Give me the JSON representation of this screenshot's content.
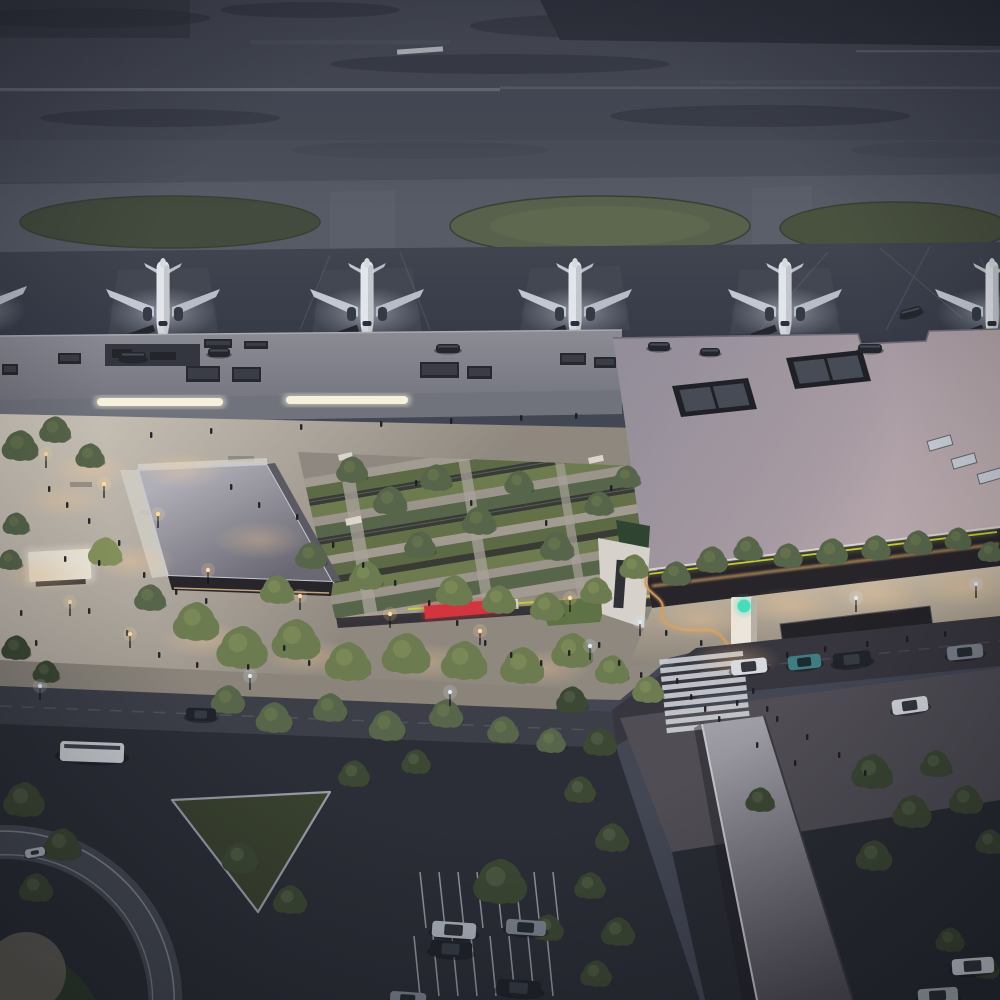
{
  "image": {
    "kind": "architectural-rendering",
    "subject": "Aerial dusk view of an airport: runway field, apron with parked jets, terminal buildings, landscaped arrival plaza with sunken gardens, drop-off road, covered pedestrian walkway and parking",
    "time_of_day": "dusk",
    "camera": "high oblique aerial"
  },
  "palette": {
    "base": "#434754",
    "runway_a": "#4e525e",
    "runway_b": "#474b57",
    "taxiway": "#575b66",
    "apron_a": "#40444f",
    "apron_b": "#353946",
    "grass_dark": "#434b3e",
    "grass_mid": "#57614c",
    "grass_light": "#626c50",
    "roof_old_a": "#8b8b94",
    "roof_old_b": "#757680",
    "roof_new_a": "#938e9a",
    "roof_new_b": "#a79aa2",
    "roof_new_c": "#c3b3b4",
    "ramp_a": "#b0afb8",
    "ramp_b": "#6a6973",
    "plaza_a": "#cfc8bd",
    "plaza_b": "#8f887f",
    "sidewalk_a": "#d2c3ab",
    "sidewalk_b": "#8e867c",
    "road": "#3c3f48",
    "road_bend": "#37353d",
    "parking": "#2b2d36",
    "walk_canopy_a": "#a09ea6",
    "walk_canopy_b": "#514e57",
    "storefront": "#3b3735",
    "storefront_light": "#d8a566",
    "tree_0": "#3c4734",
    "tree_1": "#57654a",
    "tree_2": "#6d7b50",
    "tree_3": "#85915c",
    "accent_lime": "#c9d33f",
    "accent_red": "#d2353e",
    "logo_teal": "#45dcbc",
    "warm_light": "#ffd9a0",
    "cool_light": "#dfe7f2",
    "fuselage": "#e2e5ea",
    "wing": "#c2c8d1",
    "dark_detail": "#23252c",
    "white_mark": "#ccd0d7",
    "car_colors": {
      "white": "#d7dbe0",
      "silver": "#aeb4bc",
      "gray": "#7b828c",
      "teal": "#3e7e83",
      "dark": "#20232a",
      "bus": "#c9ccd1",
      "ground": "#23262c"
    }
  },
  "airside": {
    "plane_xs": [
      163,
      367,
      575,
      785
    ],
    "partial_planes": [
      [
        -30,
        330
      ],
      [
        992,
        333
      ]
    ],
    "runway_dash": [
      397,
      48
    ]
  },
  "buildings": {
    "hvac_units": [
      [
        2,
        364,
        16,
        11
      ],
      [
        58,
        353,
        23,
        11
      ],
      [
        186,
        366,
        34,
        16
      ],
      [
        232,
        367,
        29,
        15
      ],
      [
        420,
        362,
        39,
        16
      ],
      [
        467,
        366,
        25,
        13
      ],
      [
        204,
        339,
        28,
        9
      ],
      [
        244,
        341,
        24,
        8
      ],
      [
        560,
        353,
        26,
        12
      ],
      [
        594,
        357,
        22,
        11
      ]
    ],
    "skylight_strips": [
      [
        97,
        398,
        126,
        8
      ],
      [
        286,
        396,
        122,
        8
      ]
    ],
    "roof_boxes": [
      [
        [
          672,
          386
        ],
        [
          748,
          378
        ],
        [
          757,
          409
        ],
        [
          681,
          417
        ]
      ],
      [
        [
          786,
          358
        ],
        [
          862,
          350
        ],
        [
          871,
          381
        ],
        [
          795,
          389
        ]
      ]
    ],
    "roof_vents": [
      [
        928,
        438
      ],
      [
        952,
        456
      ],
      [
        978,
        471
      ]
    ],
    "shelters": [
      [
        [
          780,
          624
        ],
        [
          930,
          606
        ],
        [
          934,
          634
        ],
        [
          784,
          652
        ]
      ],
      [
        [
          944,
          712
        ],
        [
          1000,
          700
        ],
        [
          1000,
          734
        ],
        [
          948,
          746
        ]
      ]
    ],
    "pylon": [
      731,
      597,
      26,
      56
    ]
  },
  "plaza": {
    "canopies": [
      [
        345,
        519,
        16,
        7
      ],
      [
        338,
        455,
        14,
        6
      ],
      [
        588,
        458,
        15,
        6
      ],
      [
        610,
        601,
        14,
        6
      ]
    ],
    "benches": [
      [
        70,
        482,
        22,
        5
      ],
      [
        140,
        510,
        20,
        5
      ],
      [
        228,
        456,
        26,
        6
      ],
      [
        196,
        470,
        18,
        5
      ]
    ],
    "red_bench": [
      424,
      606,
      76,
      13
    ],
    "kiosk": [
      28,
      552,
      62,
      30
    ],
    "light_pools": [
      [
        62,
        500
      ],
      [
        132,
        562
      ],
      [
        205,
        640
      ],
      [
        310,
        657
      ],
      [
        428,
        662
      ],
      [
        545,
        668
      ],
      [
        88,
        470
      ],
      [
        40,
        575
      ],
      [
        700,
        620
      ],
      [
        790,
        606
      ],
      [
        880,
        596
      ],
      [
        965,
        588
      ],
      [
        736,
        660
      ],
      [
        180,
        470
      ],
      [
        260,
        540
      ]
    ]
  },
  "roadside": {
    "zebra": {
      "x": 663,
      "y": 655,
      "w": 84,
      "h": 5.2,
      "step": 8.6,
      "count": 9,
      "angle": -6
    },
    "parking_rows": [
      {
        "x": 420,
        "y": 872,
        "n": 8,
        "dx": 19,
        "len": 56
      },
      {
        "x": 414,
        "y": 936,
        "n": 8,
        "dx": 19,
        "len": 60
      }
    ],
    "storefront_lights": {
      "x0": 8,
      "x1": 616,
      "step": 26,
      "slope": 0.0316,
      "y0": 432
    }
  },
  "entities": {
    "trees": [
      [
        20,
        446,
        15,
        1
      ],
      [
        55,
        430,
        13,
        1
      ],
      [
        90,
        456,
        12,
        1
      ],
      [
        16,
        524,
        11,
        1
      ],
      [
        10,
        560,
        10,
        1
      ],
      [
        105,
        552,
        14,
        3
      ],
      [
        150,
        598,
        13,
        1
      ],
      [
        196,
        622,
        19,
        2
      ],
      [
        242,
        648,
        21,
        2
      ],
      [
        296,
        640,
        20,
        2
      ],
      [
        348,
        662,
        19,
        2
      ],
      [
        406,
        654,
        20,
        2
      ],
      [
        464,
        661,
        19,
        2
      ],
      [
        522,
        666,
        18,
        2
      ],
      [
        572,
        651,
        17,
        2
      ],
      [
        612,
        670,
        14,
        2
      ],
      [
        648,
        690,
        13,
        2
      ],
      [
        352,
        470,
        13,
        1
      ],
      [
        390,
        501,
        14,
        1
      ],
      [
        436,
        478,
        13,
        1
      ],
      [
        479,
        521,
        14,
        1
      ],
      [
        519,
        483,
        12,
        1
      ],
      [
        557,
        547,
        14,
        1
      ],
      [
        599,
        504,
        12,
        1
      ],
      [
        627,
        477,
        11,
        1
      ],
      [
        454,
        591,
        15,
        2
      ],
      [
        499,
        600,
        14,
        2
      ],
      [
        547,
        607,
        14,
        2
      ],
      [
        596,
        591,
        13,
        2
      ],
      [
        634,
        567,
        12,
        2
      ],
      [
        420,
        545,
        13,
        1
      ],
      [
        366,
        576,
        14,
        2
      ],
      [
        311,
        556,
        13,
        1
      ],
      [
        277,
        590,
        14,
        2
      ],
      [
        676,
        574,
        12,
        1
      ],
      [
        712,
        560,
        13,
        1
      ],
      [
        748,
        549,
        12,
        1
      ],
      [
        788,
        556,
        12,
        1
      ],
      [
        832,
        552,
        13,
        1
      ],
      [
        876,
        548,
        12,
        1
      ],
      [
        918,
        543,
        12,
        1
      ],
      [
        958,
        539,
        11,
        1
      ],
      [
        990,
        552,
        10,
        1
      ],
      [
        228,
        700,
        14,
        1
      ],
      [
        274,
        718,
        15,
        1
      ],
      [
        330,
        708,
        14,
        1
      ],
      [
        387,
        726,
        15,
        1
      ],
      [
        446,
        714,
        14,
        1
      ],
      [
        503,
        730,
        13,
        1
      ],
      [
        551,
        741,
        12,
        1
      ],
      [
        16,
        648,
        12,
        0
      ],
      [
        46,
        672,
        11,
        0
      ],
      [
        24,
        800,
        17,
        0
      ],
      [
        62,
        845,
        16,
        0
      ],
      [
        36,
        888,
        14,
        0
      ],
      [
        240,
        858,
        15,
        0
      ],
      [
        290,
        900,
        14,
        0
      ],
      [
        500,
        882,
        22,
        0
      ],
      [
        548,
        928,
        13,
        0
      ],
      [
        354,
        774,
        13,
        0
      ],
      [
        416,
        762,
        12,
        0
      ],
      [
        572,
        700,
        13,
        0
      ],
      [
        600,
        742,
        14,
        0
      ],
      [
        580,
        790,
        13,
        0
      ],
      [
        612,
        838,
        14,
        0
      ],
      [
        590,
        886,
        13,
        0
      ],
      [
        618,
        932,
        14,
        0
      ],
      [
        596,
        974,
        13,
        0
      ],
      [
        872,
        772,
        17,
        0
      ],
      [
        912,
        812,
        16,
        0
      ],
      [
        874,
        856,
        15,
        0
      ],
      [
        936,
        764,
        13,
        0
      ],
      [
        966,
        800,
        14,
        0
      ],
      [
        990,
        842,
        12,
        0
      ],
      [
        950,
        940,
        12,
        0
      ],
      [
        986,
        968,
        11,
        0
      ],
      [
        760,
        800,
        12,
        0
      ]
    ],
    "people": [
      [
        48,
        486
      ],
      [
        66,
        502
      ],
      [
        88,
        518
      ],
      [
        118,
        540
      ],
      [
        64,
        556
      ],
      [
        98,
        560
      ],
      [
        143,
        572
      ],
      [
        175,
        589
      ],
      [
        205,
        598
      ],
      [
        88,
        608
      ],
      [
        126,
        630
      ],
      [
        158,
        652
      ],
      [
        196,
        662
      ],
      [
        247,
        664
      ],
      [
        283,
        645
      ],
      [
        308,
        660
      ],
      [
        230,
        484
      ],
      [
        258,
        502
      ],
      [
        296,
        514
      ],
      [
        332,
        542
      ],
      [
        362,
        562
      ],
      [
        394,
        580
      ],
      [
        428,
        600
      ],
      [
        456,
        620
      ],
      [
        484,
        640
      ],
      [
        510,
        652
      ],
      [
        540,
        660
      ],
      [
        568,
        650
      ],
      [
        598,
        642
      ],
      [
        618,
        660
      ],
      [
        640,
        672
      ],
      [
        676,
        678
      ],
      [
        690,
        694
      ],
      [
        704,
        706
      ],
      [
        718,
        716
      ],
      [
        736,
        700
      ],
      [
        752,
        688
      ],
      [
        766,
        706
      ],
      [
        786,
        652
      ],
      [
        824,
        646
      ],
      [
        866,
        641
      ],
      [
        906,
        636
      ],
      [
        944,
        631
      ],
      [
        700,
        640
      ],
      [
        665,
        630
      ],
      [
        776,
        716
      ],
      [
        806,
        734
      ],
      [
        838,
        752
      ],
      [
        864,
        770
      ],
      [
        794,
        760
      ],
      [
        756,
        742
      ],
      [
        150,
        432
      ],
      [
        210,
        428
      ],
      [
        300,
        424
      ],
      [
        380,
        421
      ],
      [
        450,
        418
      ],
      [
        520,
        415
      ],
      [
        575,
        413
      ],
      [
        415,
        480
      ],
      [
        470,
        500
      ],
      [
        545,
        520
      ],
      [
        610,
        485
      ],
      [
        35,
        640
      ],
      [
        20,
        610
      ]
    ],
    "cars": [
      [
        731,
        659,
        36,
        15,
        -6,
        "white"
      ],
      [
        788,
        655,
        33,
        14,
        -6,
        "teal"
      ],
      [
        833,
        652,
        38,
        15,
        -6,
        "dark"
      ],
      [
        947,
        645,
        36,
        14,
        -6,
        "gray"
      ],
      [
        892,
        698,
        36,
        15,
        -8,
        "white"
      ],
      [
        60,
        742,
        64,
        20,
        2,
        "bus"
      ],
      [
        186,
        708,
        30,
        13,
        2,
        "dark"
      ],
      [
        432,
        922,
        44,
        16,
        4,
        "silver"
      ],
      [
        430,
        941,
        42,
        16,
        4,
        "dark"
      ],
      [
        506,
        920,
        40,
        15,
        4,
        "gray"
      ],
      [
        497,
        980,
        44,
        16,
        4,
        "dark"
      ],
      [
        390,
        992,
        36,
        14,
        4,
        "gray"
      ],
      [
        952,
        958,
        42,
        16,
        -4,
        "white"
      ],
      [
        918,
        988,
        40,
        15,
        -4,
        "silver"
      ],
      [
        120,
        352,
        26,
        10,
        0,
        "ground"
      ],
      [
        208,
        348,
        22,
        9,
        0,
        "ground"
      ],
      [
        436,
        344,
        24,
        9,
        0,
        "ground"
      ],
      [
        648,
        342,
        22,
        9,
        0,
        "ground"
      ],
      [
        700,
        348,
        20,
        8,
        0,
        "ground"
      ],
      [
        858,
        344,
        24,
        9,
        0,
        "ground"
      ],
      [
        900,
        308,
        22,
        9,
        -15,
        "ground"
      ],
      [
        25,
        848,
        20,
        9,
        -10,
        "silver"
      ]
    ],
    "lamps": {
      "warm": [
        [
          46,
          468
        ],
        [
          104,
          498
        ],
        [
          158,
          528
        ],
        [
          70,
          616
        ],
        [
          130,
          648
        ],
        [
          208,
          584
        ],
        [
          300,
          610
        ],
        [
          390,
          628
        ],
        [
          480,
          645
        ],
        [
          570,
          612
        ]
      ],
      "cool": [
        [
          640,
          636
        ],
        [
          856,
          612
        ],
        [
          976,
          598
        ],
        [
          250,
          690
        ],
        [
          450,
          706
        ],
        [
          40,
          700
        ],
        [
          590,
          660
        ]
      ]
    }
  }
}
